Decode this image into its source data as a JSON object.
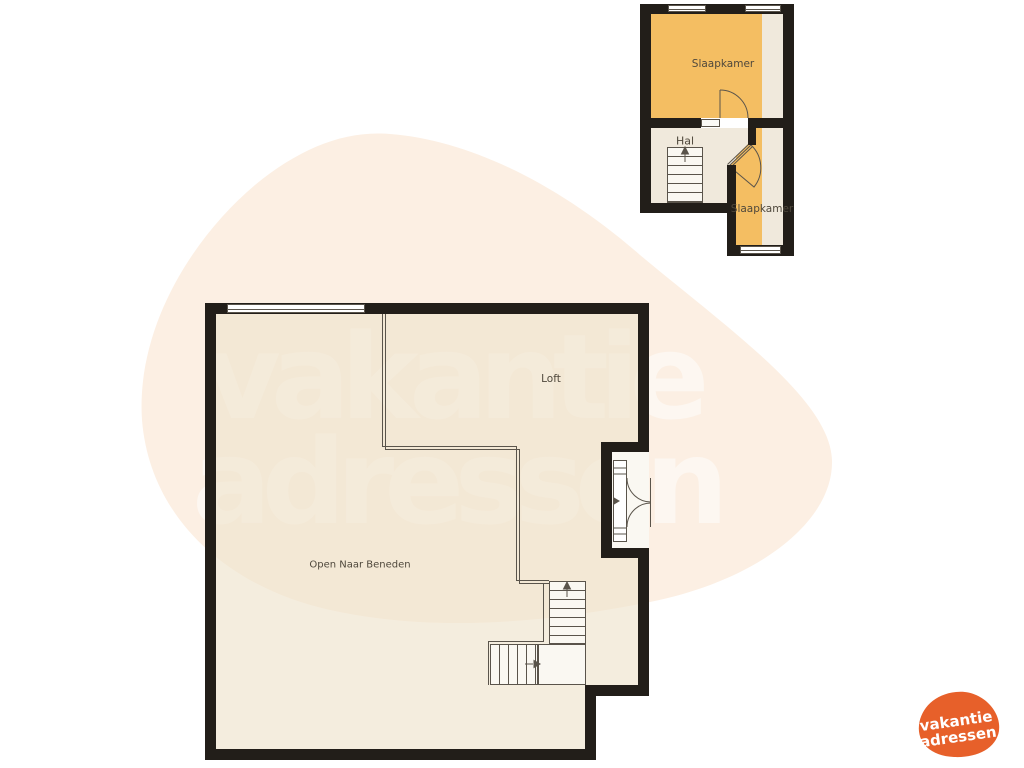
{
  "watermark": {
    "line1": "vakantie",
    "line2": "adressen"
  },
  "logo": {
    "line1": "vakantie",
    "line2": "adressen"
  },
  "upper_plan": {
    "rooms": [
      {
        "id": "slaapkamer-top",
        "label": "Slaapkamer",
        "fill": "orange"
      },
      {
        "id": "hal",
        "label": "Hal",
        "fill": "beige"
      },
      {
        "id": "slaapkamer-bottom",
        "label": "Slaapkamer",
        "fill": "orange"
      }
    ],
    "features": [
      "stairs-up-arrow",
      "two-top-windows",
      "bottom-window",
      "swing-door",
      "diagonal-corner-door"
    ]
  },
  "main_plan": {
    "rooms": [
      {
        "id": "loft",
        "label": "Loft"
      },
      {
        "id": "void",
        "label": "Open Naar Beneden"
      }
    ],
    "features": [
      "top-window",
      "french-doors-right",
      "l-shaped-stairs",
      "loft-railing"
    ]
  },
  "colors": {
    "wall": "#221e19",
    "thin_line": "#5a544b",
    "orange_room": "#f4be62",
    "beige_floor": "#f0e9dc",
    "blob": "#fcefe3",
    "watermark_text": "#fdf7f1",
    "white_fill": "#faf8f2",
    "label_text": "#4f483c",
    "logo_orange": "#e7602a"
  }
}
